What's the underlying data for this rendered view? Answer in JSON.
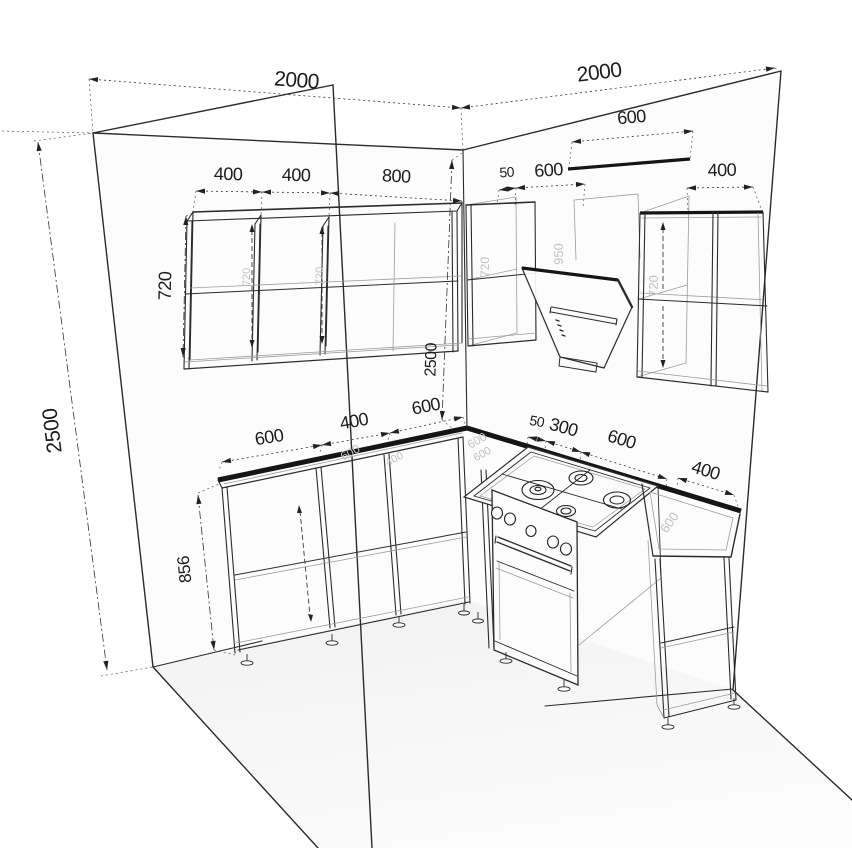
{
  "diagram_data": {
    "type": "kitchen-corner-3d-wireframe-drawing",
    "units": "mm",
    "room": {
      "left_wall_width": "2000",
      "right_wall_width": "2000",
      "wall_height": "2500"
    },
    "upper_cabinets": {
      "left_wall_widths": [
        "400",
        "400",
        "800"
      ],
      "right_wall_widths": [
        "50",
        "600",
        "400"
      ],
      "hood_width": "600",
      "cabinet_height": "720"
    },
    "base_cabinets": {
      "left_wall_widths": [
        "600",
        "400",
        "600"
      ],
      "right_wall_widths": [
        "50",
        "300",
        "600",
        "400"
      ],
      "base_height": "856"
    }
  },
  "annotations": {
    "dimensions": [
      {
        "id": "dim-2000-left",
        "label": "2000",
        "x1": 89,
        "y1": 79,
        "x2": 461,
        "y2": 108,
        "tx": 296,
        "ty": 87,
        "rot": 4.5,
        "fs": 21,
        "style": "dotted"
      },
      {
        "id": "dim-2000-right",
        "label": "2000",
        "x1": 461,
        "y1": 108,
        "x2": 775,
        "y2": 68,
        "tx": 600,
        "ty": 79,
        "rot": -7,
        "fs": 21,
        "style": "dotted"
      },
      {
        "id": "dim-600-hood",
        "label": "600",
        "x1": 572,
        "y1": 142,
        "x2": 693,
        "y2": 131,
        "tx": 632,
        "ty": 123,
        "rot": -5,
        "fs": 18,
        "style": "dotted"
      },
      {
        "id": "dim-400-upper-1",
        "label": "400",
        "x1": 196,
        "y1": 191,
        "x2": 262,
        "y2": 192,
        "tx": 228,
        "ty": 180,
        "rot": 1,
        "fs": 18,
        "style": "dotted"
      },
      {
        "id": "dim-400-upper-2",
        "label": "400",
        "x1": 262,
        "y1": 192,
        "x2": 330,
        "y2": 193,
        "tx": 296,
        "ty": 181,
        "rot": 1,
        "fs": 18,
        "style": "dotted"
      },
      {
        "id": "dim-800-upper",
        "label": "800",
        "x1": 330,
        "y1": 193,
        "x2": 462,
        "y2": 201,
        "tx": 396,
        "ty": 182,
        "rot": 3,
        "fs": 18,
        "style": "dotted"
      },
      {
        "id": "dim-50-upper",
        "label": "50",
        "x1": 499,
        "y1": 190,
        "x2": 516,
        "y2": 188,
        "tx": 507,
        "ty": 177,
        "rot": -4,
        "fs": 14,
        "style": "dotted"
      },
      {
        "id": "dim-600-upper-right",
        "label": "600",
        "x1": 516,
        "y1": 188,
        "x2": 585,
        "y2": 184,
        "tx": 549,
        "ty": 176,
        "rot": -4,
        "fs": 18,
        "style": "dotted"
      },
      {
        "id": "dim-400-upper-right",
        "label": "400",
        "x1": 687,
        "y1": 188,
        "x2": 753,
        "y2": 187,
        "tx": 722,
        "ty": 176,
        "rot": -1,
        "fs": 18,
        "style": "dotted"
      },
      {
        "id": "dim-720-upper-height",
        "label": "720",
        "x1": 186,
        "y1": 216,
        "x2": 183,
        "y2": 357,
        "tx": 171,
        "ty": 286,
        "rot": -89,
        "fs": 18,
        "style": "dashdot"
      },
      {
        "id": "dim-2500-wall-height",
        "label": "2500",
        "x1": 38,
        "y1": 142,
        "x2": 107,
        "y2": 670,
        "tx": 59,
        "ty": 430,
        "rot": -97,
        "fs": 21,
        "style": "dashdot"
      },
      {
        "id": "dim-2500-corner-height",
        "label": "2500",
        "x1": 452,
        "y1": 160,
        "x2": 442,
        "y2": 420,
        "tx": 436,
        "ty": 360,
        "rot": -88,
        "fs": 16,
        "style": "dashdot"
      },
      {
        "id": "dim-856-base-height",
        "label": "856",
        "x1": 198,
        "y1": 495,
        "x2": 214,
        "y2": 650,
        "tx": 190,
        "ty": 569,
        "rot": -96,
        "fs": 17,
        "style": "dashdot"
      },
      {
        "id": "dim-600-base-1",
        "label": "600",
        "x1": 222,
        "y1": 462,
        "x2": 322,
        "y2": 445,
        "tx": 270,
        "ty": 443,
        "rot": -9,
        "fs": 18,
        "style": "dotted"
      },
      {
        "id": "dim-400-base",
        "label": "400",
        "x1": 322,
        "y1": 445,
        "x2": 390,
        "y2": 433,
        "tx": 355,
        "ty": 427,
        "rot": -10,
        "fs": 18,
        "style": "dotted"
      },
      {
        "id": "dim-600-base-2",
        "label": "600",
        "x1": 390,
        "y1": 433,
        "x2": 463,
        "y2": 417,
        "tx": 427,
        "ty": 412,
        "rot": -11,
        "fs": 18,
        "style": "dotted"
      },
      {
        "id": "dim-50-base",
        "label": "50",
        "x1": 528,
        "y1": 437,
        "x2": 546,
        "y2": 441,
        "tx": 536,
        "ty": 426,
        "rot": 10,
        "fs": 14,
        "style": "dotted"
      },
      {
        "id": "dim-300-base",
        "label": "300",
        "x1": 546,
        "y1": 441,
        "x2": 581,
        "y2": 452,
        "tx": 562,
        "ty": 433,
        "rot": 15,
        "fs": 18,
        "style": "dotted"
      },
      {
        "id": "dim-600-base-right",
        "label": "600",
        "x1": 581,
        "y1": 452,
        "x2": 667,
        "y2": 479,
        "tx": 620,
        "ty": 445,
        "rot": 17,
        "fs": 18,
        "style": "dotted"
      },
      {
        "id": "dim-400-base-right",
        "label": "400",
        "x1": 678,
        "y1": 478,
        "x2": 734,
        "y2": 495,
        "tx": 704,
        "ty": 476,
        "rot": 17,
        "fs": 18,
        "style": "dotted"
      }
    ],
    "surface_labels": [
      {
        "id": "label-950-hood",
        "text": "950",
        "x": 563,
        "y": 254,
        "rot": -90,
        "fs": 13
      },
      {
        "id": "label-720-right-cab",
        "text": "720",
        "x": 658,
        "y": 286,
        "rot": -90,
        "fs": 13
      },
      {
        "id": "label-720-corner-cab",
        "text": "720",
        "x": 489,
        "y": 267,
        "rot": -90,
        "fs": 12
      },
      {
        "id": "label-720-upper-1",
        "text": "720",
        "x": 250,
        "y": 277,
        "rot": -90,
        "fs": 11
      },
      {
        "id": "label-720-upper-2",
        "text": "720",
        "x": 323,
        "y": 276,
        "rot": -90,
        "fs": 11
      },
      {
        "id": "label-600-counter-1",
        "text": "600",
        "x": 352,
        "y": 456,
        "rot": -28,
        "fs": 12
      },
      {
        "id": "label-400-counter",
        "text": "400",
        "x": 396,
        "y": 462,
        "rot": -28,
        "fs": 11
      },
      {
        "id": "label-600-counter-2",
        "text": "600",
        "x": 479,
        "y": 444,
        "rot": -30,
        "fs": 12
      },
      {
        "id": "label-600-counter-3",
        "text": "600",
        "x": 484,
        "y": 457,
        "rot": -30,
        "fs": 11
      },
      {
        "id": "label-600-counter-right",
        "text": "600",
        "x": 673,
        "y": 525,
        "rot": -55,
        "fs": 13
      }
    ]
  },
  "colors": {
    "line": "#2b2b2b",
    "dimension": "#1c1c1c",
    "faint_label": "#c2c2c2",
    "background": "#ffffff",
    "floor": "#f4f4f4"
  }
}
